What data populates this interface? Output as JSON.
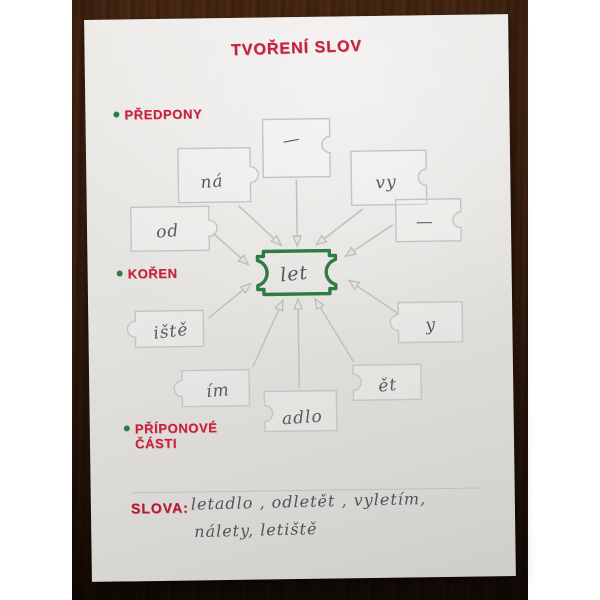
{
  "title": "TVOŘENÍ SLOV",
  "sections": {
    "prefixes_label": "PŘEDPONY",
    "root_label": "KOŘEN",
    "suffixes_label_line1": "PŘÍPONOVÉ",
    "suffixes_label_line2": "ČÁSTI"
  },
  "diagram": {
    "root": "let",
    "prefixes": [
      "—",
      "ná",
      "vy",
      "od",
      "—"
    ],
    "suffixes": [
      "iště",
      "ím",
      "adlo",
      "ět",
      "y"
    ]
  },
  "words": {
    "heading": "SLOVA:",
    "line1": "letadlo , odletět , vyletím,",
    "line2": "nálety, letiště"
  },
  "colors": {
    "marker_red": "#c81f3c",
    "marker_green": "#2e7b45",
    "pencil_gray": "#565b5e",
    "emboss_gray": "#c1c6c2",
    "paper": "#e3e2df",
    "wood_brown": "#4a2a16"
  }
}
